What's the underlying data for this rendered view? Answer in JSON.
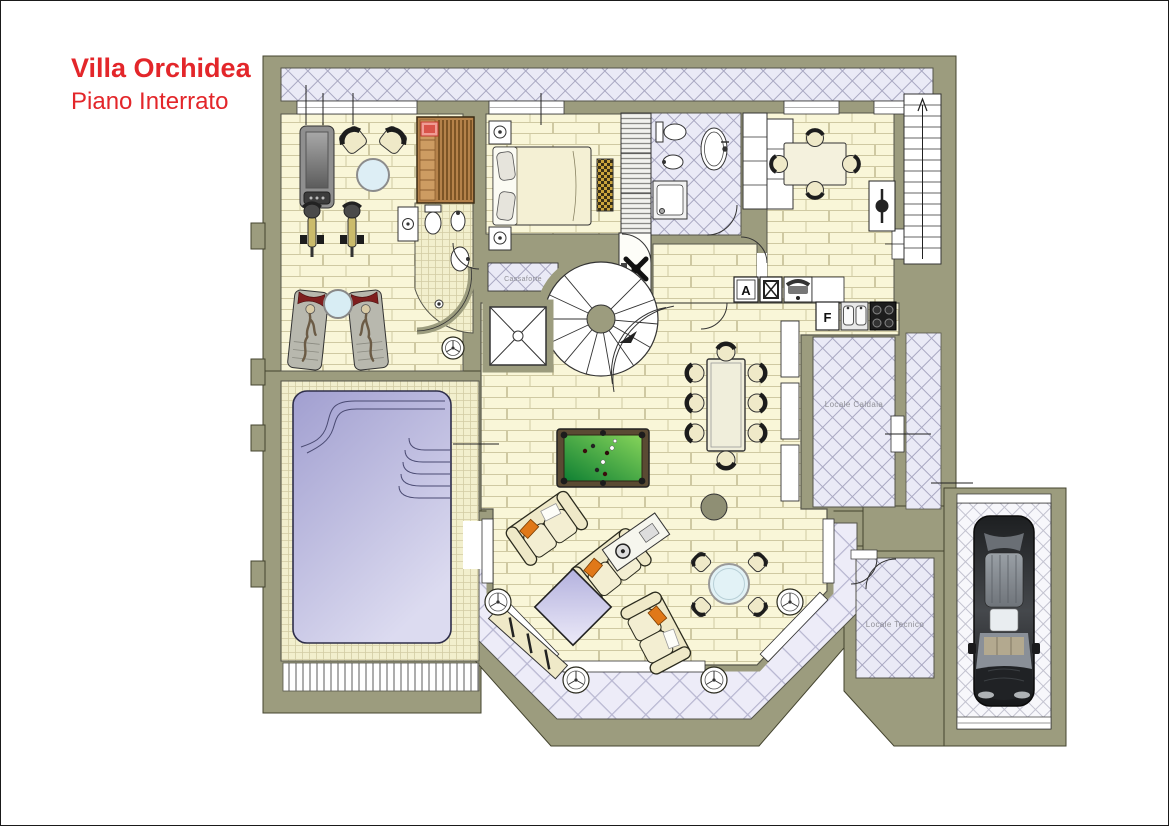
{
  "header": {
    "title": "Villa Orchidea",
    "subtitle": "Piano Interrato"
  },
  "labels": {
    "safe": "Cassaforte",
    "boiler": "Locale Caldaia",
    "technical": "Locale Tecnico"
  },
  "symbols": {
    "washer": "A",
    "freezer": "F"
  },
  "colors": {
    "title_red": "#e3262a",
    "wall_olive": "#9c9c7e",
    "floor_cream": "#f9f6d8",
    "terrace_lavender": "#edecf8",
    "pool_violet": "#aeacd8",
    "billiard_green": "#2f9e44",
    "label_gray": "#8f8f96",
    "sofa_cream": "#efe9c8",
    "cushion_orange": "#e07818",
    "sauna_wood": "#b5824a"
  }
}
